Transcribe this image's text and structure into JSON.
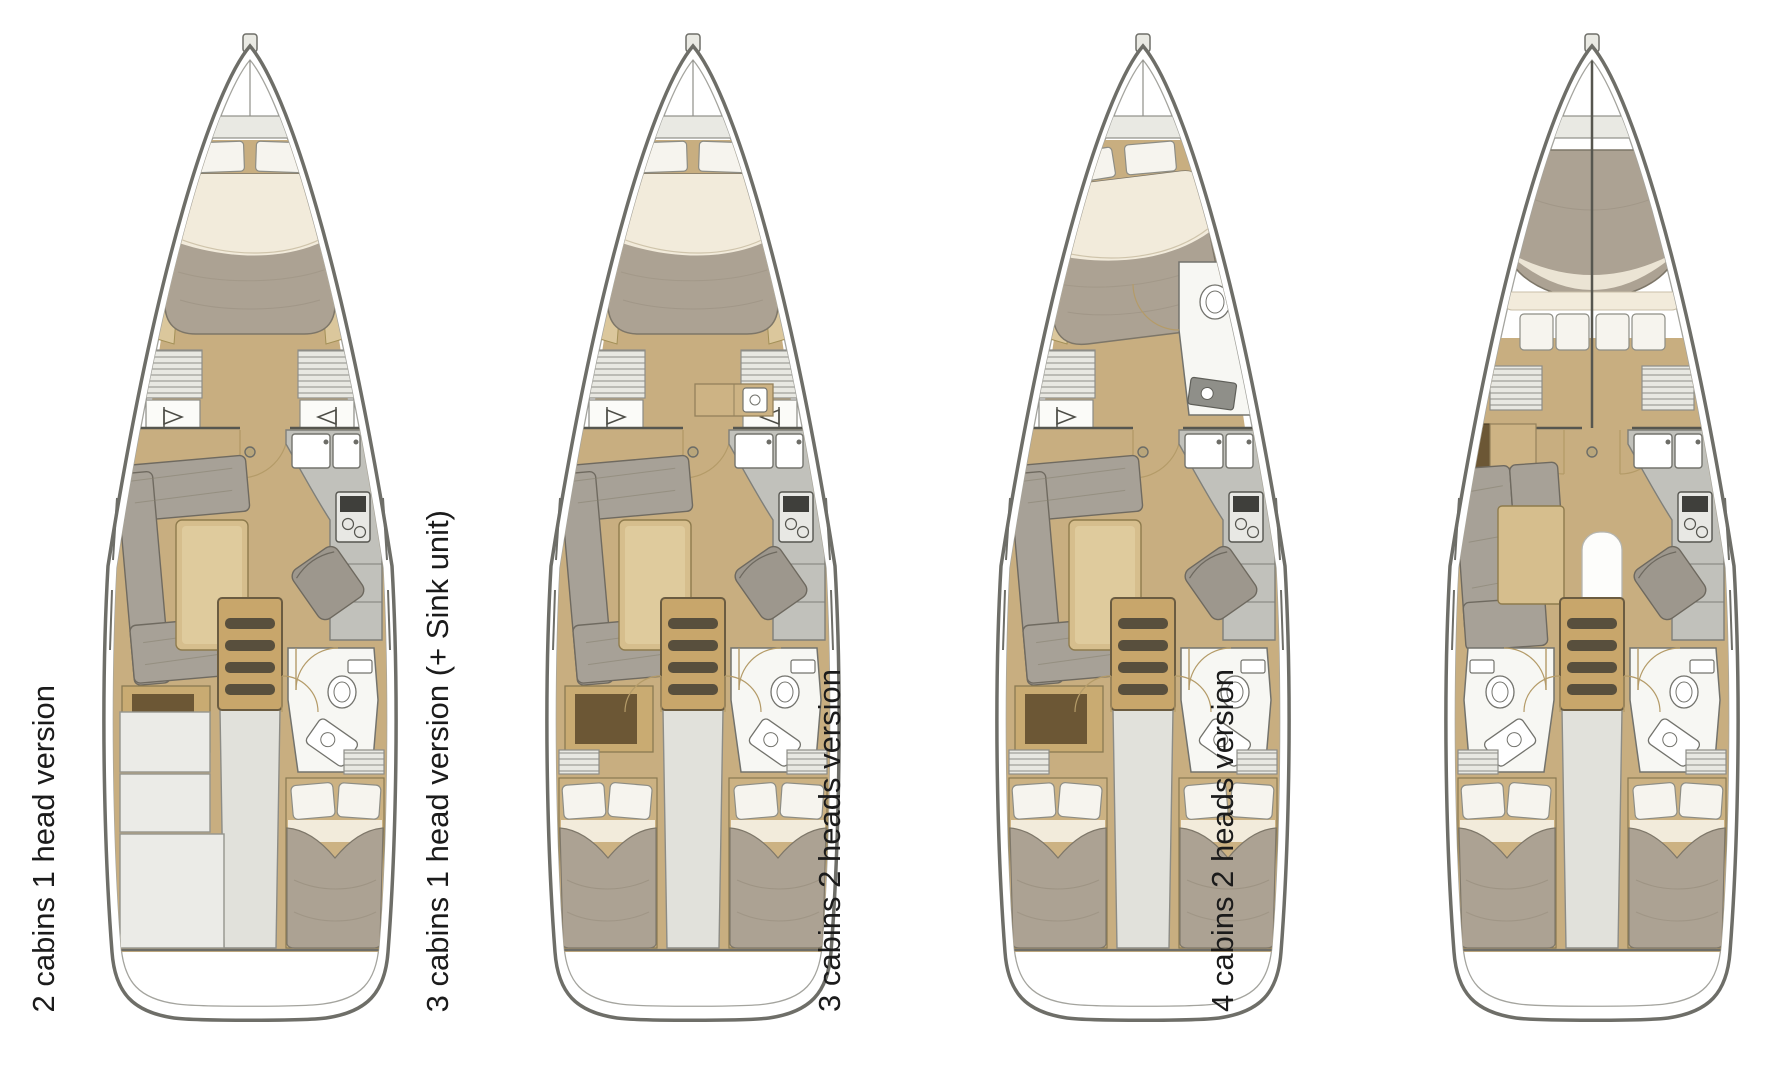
{
  "plans": [
    {
      "label": "2 cabins 1 head version",
      "layout": {
        "fwd_cabin": "owner",
        "fwd_head": false,
        "fwd_sink_unit": false,
        "chart_table": true,
        "aft_port": "storage",
        "aft_starboard": "cabin",
        "aft_heads": [
          "starboard"
        ]
      }
    },
    {
      "label": "3 cabins 1 head version (+ Sink unit)",
      "layout": {
        "fwd_cabin": "owner",
        "fwd_head": false,
        "fwd_sink_unit": true,
        "chart_table": true,
        "aft_port": "cabin",
        "aft_starboard": "cabin",
        "aft_heads": [
          "starboard"
        ]
      }
    },
    {
      "label": "3 cabins 2 heads version",
      "layout": {
        "fwd_cabin": "owner-angled",
        "fwd_head": true,
        "fwd_sink_unit": false,
        "chart_table": true,
        "aft_port": "cabin",
        "aft_starboard": "cabin",
        "aft_heads": [
          "starboard"
        ]
      }
    },
    {
      "label": "4 cabins 2 heads version",
      "layout": {
        "fwd_cabin": "split",
        "fwd_head": false,
        "fwd_sink_unit": false,
        "chart_table": false,
        "aft_port": "cabin",
        "aft_starboard": "cabin",
        "aft_heads": [
          "port",
          "starboard"
        ]
      }
    }
  ],
  "colors": {
    "hull": "#6e6e68",
    "inner_hull": "#a4a49e",
    "floor": "#c8ae80",
    "blanket": "#aca293",
    "sheet": "#f2ebdb",
    "pillow": "#f6f4ee",
    "pillow_stroke": "#8d8d85",
    "sofa": "#a7a197",
    "sofa_stroke": "#6f6a60",
    "table": "#d6be8d",
    "table_stroke": "#8e7b4d",
    "counter": "#c1c1bb",
    "counter_stroke": "#7f7f79",
    "hatch_bg": "#e8e8e2",
    "hatch_line": "#8e8e88",
    "head_floor": "#f7f7f3",
    "fixture_stroke": "#73736d",
    "walkway": "#e1e1db",
    "walkway_stroke": "#8c8c86",
    "stairs": "#c8a66b",
    "stairs_stroke": "#6b5c41",
    "rung": "#584f3d",
    "storage": "#ebebe7",
    "storage_stroke": "#95958d",
    "dark_wood": "#6c5735",
    "cabinet": "#cdb384",
    "cabinet_stroke": "#94815b",
    "door_arc": "#b49b68",
    "bulkhead": "#56564f",
    "bed_base": "#ccb283",
    "bed_base_stroke": "#8a7a52",
    "mast": "#b9a67b",
    "band": "#e9e9e3"
  }
}
